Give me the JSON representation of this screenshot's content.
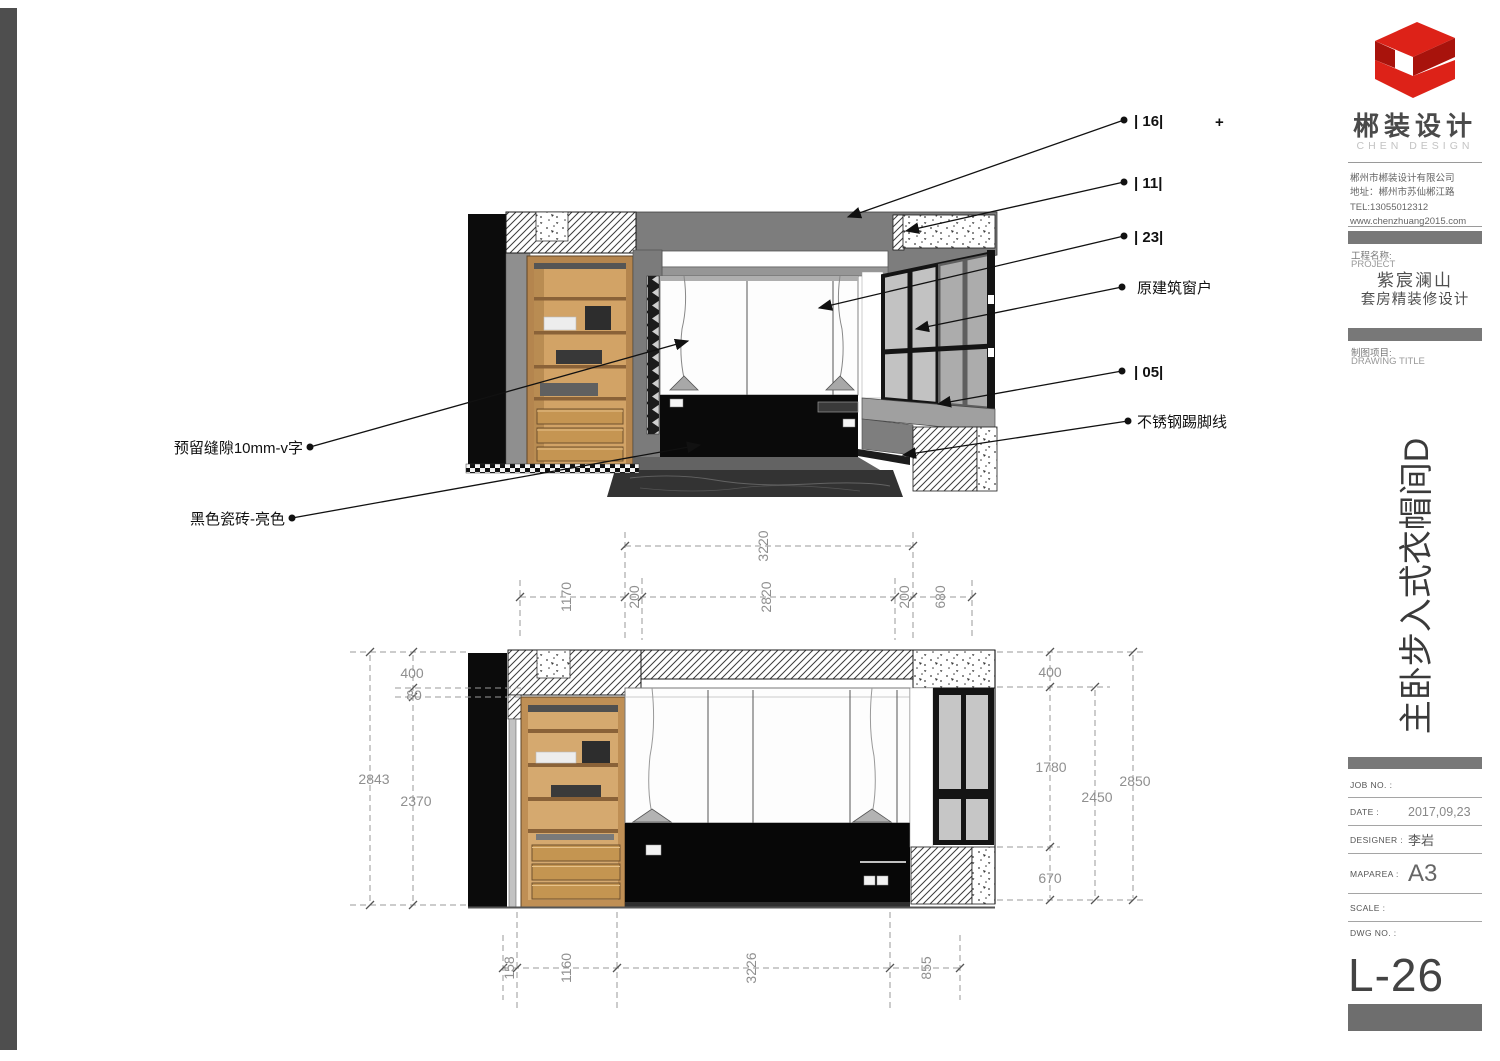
{
  "panel": {
    "brand": {
      "name": "郴装设计",
      "subtitle": "CHEN DESIGN",
      "company": "郴州市郴装设计有限公司",
      "address": "地址：郴州市苏仙郴江路",
      "tel": "TEL:13055012312",
      "website": "www.chenzhuang2015.com"
    },
    "project": {
      "label": "工程名称:",
      "label_en": "PROJECT",
      "name_line1": "紫宸澜山",
      "name_line2": "套房精装修设计"
    },
    "drawing": {
      "label": "制图项目:",
      "label_en": "DRAWING TITLE",
      "title": "主卧步入式衣帽间D"
    },
    "fields": [
      {
        "label": "JOB NO. :",
        "value": ""
      },
      {
        "label": "DATE :",
        "value": "2017,09,23"
      },
      {
        "label": "DESIGNER :",
        "value": "李岩"
      },
      {
        "label": "MAPAREA :",
        "value": "A3"
      },
      {
        "label": "SCALE :",
        "value": ""
      },
      {
        "label": "DWG NO. :",
        "value": ""
      }
    ],
    "sheet_no": "L-26"
  },
  "callouts": {
    "right": [
      "| 16|",
      "| 11|",
      "| 23|",
      "原建筑窗户",
      "| 05|",
      "不锈钢踢脚线"
    ],
    "plus": "+",
    "left": [
      "预留缝隙10mm-v字",
      "黑色瓷砖-亮色"
    ]
  },
  "dimensions": {
    "top_row1": [
      "3220"
    ],
    "top_row2": [
      "1170",
      "200",
      "2820",
      "200",
      "680"
    ],
    "left": [
      "400",
      "80",
      "2843",
      "2370"
    ],
    "right": [
      "400",
      "1780",
      "2450",
      "2850",
      "670"
    ],
    "bottom": [
      "158",
      "1160",
      "3226",
      "855"
    ]
  },
  "colors": {
    "logo_red": "#DD2218",
    "logo_red_dark": "#A8130C",
    "bar_gray": "#787878",
    "wood": "#C9995D",
    "line": "#1A1A1A",
    "dim_gray": "#8F8F8F"
  }
}
